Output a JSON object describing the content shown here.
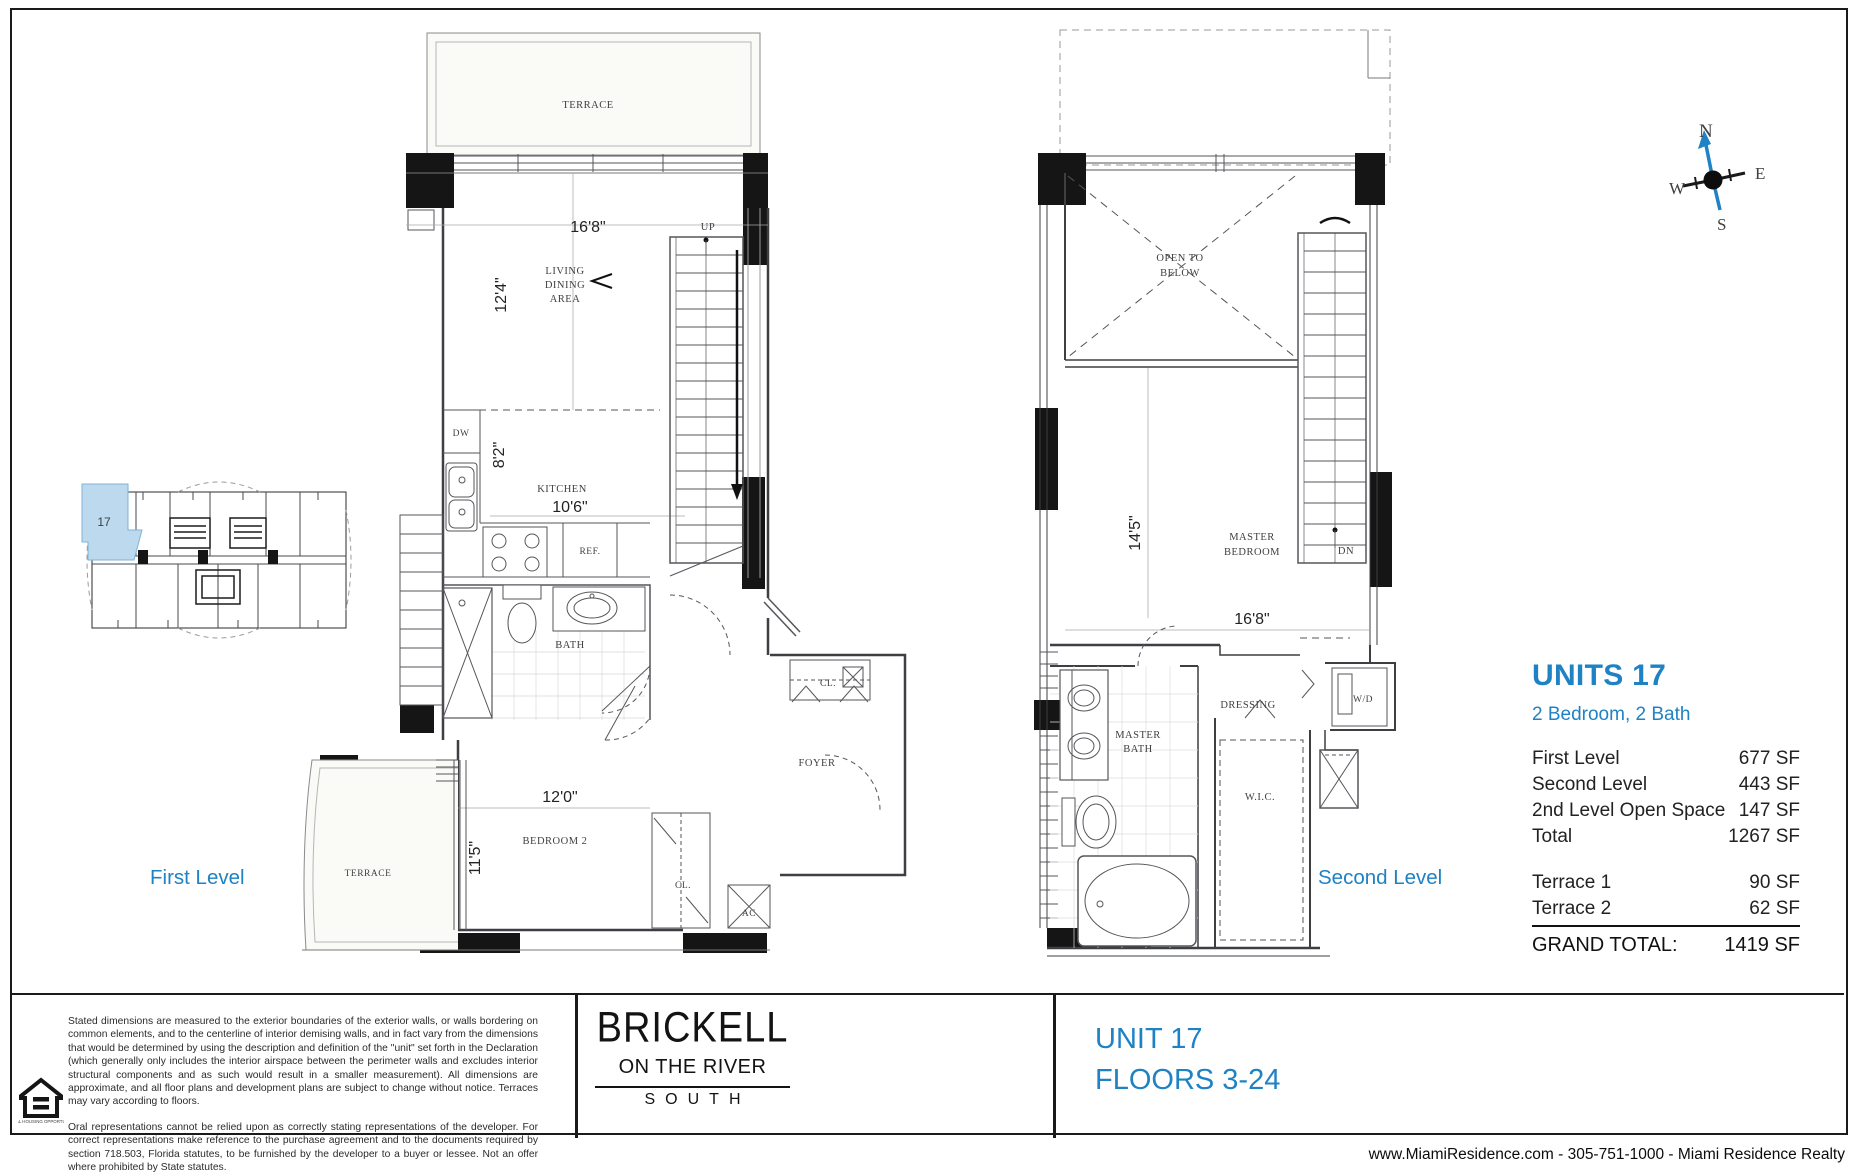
{
  "page": {
    "footer_contact": "www.MiamiResidence.com  -  305-751-1000  -  Miami Residence Realty"
  },
  "colors": {
    "accent_blue": "#1e82c4",
    "highlight_fill": "#bcd9ee",
    "wall_black": "#151515"
  },
  "compass": {
    "n": "N",
    "e": "E",
    "s": "S",
    "w": "W"
  },
  "key_plan": {
    "unit_label": "17"
  },
  "first_level": {
    "caption": "First Level",
    "terrace_top": "TERRACE",
    "terrace_bottom": "TERRACE",
    "dim_width": "16'8\"",
    "dim_living_depth": "12'4\"",
    "living_l1": "LIVING",
    "living_l2": "DINING",
    "living_l3": "AREA",
    "up": "UP",
    "dw": "DW",
    "dim_kitchen_depth": "8'2\"",
    "kitchen": "KITCHEN",
    "dim_kitchen_width": "10'6\"",
    "ref": "REF.",
    "bath": "BATH",
    "cl_foyer": "CL.",
    "foyer": "FOYER",
    "dim_bedroom_width": "12'0\"",
    "dim_bedroom_depth": "11'5\"",
    "bedroom2": "BEDROOM 2",
    "cl_bedroom": "CL.",
    "ac": "AC"
  },
  "second_level": {
    "caption": "Second Level",
    "open_l1": "OPEN TO",
    "open_l2": "BELOW",
    "dim_bedroom_depth": "14'5\"",
    "master_l1": "MASTER",
    "master_l2": "BEDROOM",
    "dn": "DN",
    "dim_bedroom_width": "16'8\"",
    "bath_l1": "MASTER",
    "bath_l2": "BATH",
    "dressing": "DRESSING",
    "wic": "W.I.C.",
    "wd": "W/D"
  },
  "stats": {
    "title": "UNITS 17",
    "subtitle": "2 Bedroom, 2 Bath",
    "rows": [
      {
        "label": "First Level",
        "value": "677 SF"
      },
      {
        "label": "Second Level",
        "value": "443 SF"
      },
      {
        "label": "2nd Level Open Space",
        "value": "147 SF"
      },
      {
        "label": "Total",
        "value": "1267 SF"
      }
    ],
    "terrace_rows": [
      {
        "label": "Terrace 1",
        "value": "90 SF"
      },
      {
        "label": "Terrace 2",
        "value": "62 SF"
      }
    ],
    "grand_total_label": "GRAND TOTAL:",
    "grand_total_value": "1419 SF"
  },
  "band": {
    "disclaimer_p1": "Stated dimensions are measured to the exterior boundaries of the exterior walls, or walls bordering on common elements, and to the centerline of interior demising walls, and in fact vary from the dimensions that would be determined by using the description and definition of the \"unit\" set forth in the Declaration (which generally only includes the interior airspace between the perimeter walls and excludes interior structural components and as such would result in a smaller measurement). All dimensions are approximate, and all floor plans and development plans are subject to change without notice. Terraces may vary according to floors.",
    "disclaimer_p2": "Oral representations cannot be relied upon as correctly stating representations of the developer. For correct representations make reference to the purchase agreement and to the documents required by section 718.503, Florida statutes, to be furnished by the developer to a buyer or lessee. Not an offer where prohibited by State statutes.",
    "eho_caption": "EQUAL HOUSING OPPORTUNITY",
    "logo_l1": "BRICKELL",
    "logo_l2": "ON THE RIVER",
    "logo_l3": "SOUTH",
    "unit_title": "UNIT 17",
    "unit_floors": "FLOORS 3-24"
  }
}
